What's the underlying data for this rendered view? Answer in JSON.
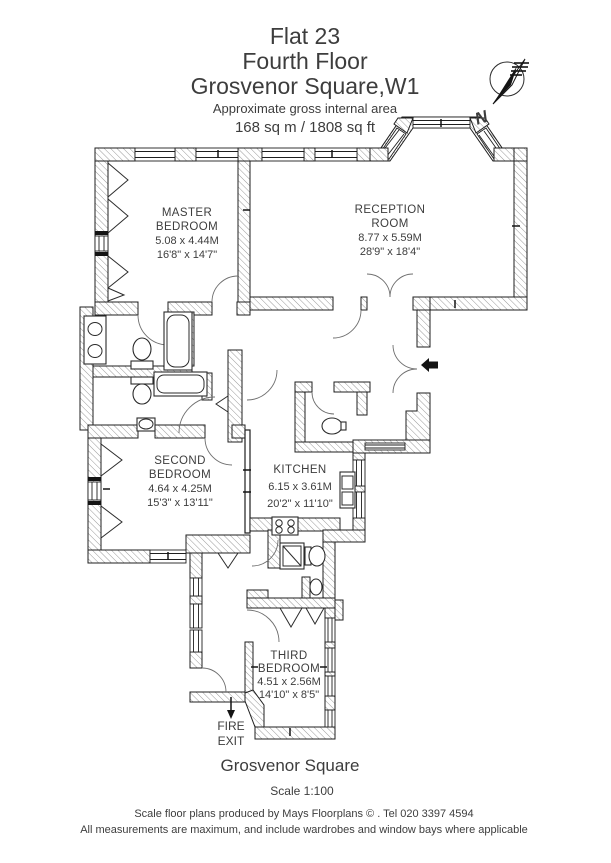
{
  "header": {
    "title1": "Flat 23",
    "title2": "Fourth Floor",
    "title3": "Grosvenor Square,W1",
    "subtitle": "Approximate gross internal area",
    "area": "168 sq m  /  1808 sq ft"
  },
  "compass": {
    "north": "N"
  },
  "rooms": {
    "master": {
      "lines": [
        "MASTER",
        "BEDROOM",
        "5.08 x 4.44M",
        "16'8\" x 14'7\""
      ]
    },
    "reception": {
      "lines": [
        "RECEPTION",
        "ROOM",
        "8.77 x 5.59M",
        "28'9\" x 18'4\""
      ]
    },
    "second": {
      "lines": [
        "SECOND",
        "BEDROOM",
        "4.64 x 4.25M",
        "15'3\" x 13'11\""
      ]
    },
    "kitchen": {
      "lines": [
        "KITCHEN",
        "6.15 x 3.61M",
        "20'2\" x 11'10\""
      ]
    },
    "third": {
      "lines": [
        "THIRD",
        "BEDROOM",
        "4.51 x 2.56M",
        "14'10\" x 8'5\""
      ]
    }
  },
  "fire": {
    "lines": [
      "FIRE",
      "EXIT"
    ]
  },
  "footer": {
    "location": "Grosvenor Square",
    "scale": "Scale 1:100",
    "credit": "Scale floor plans produced by Mays Floorplans © . Tel 020 3397 4594",
    "disclaimer": "All measurements are maximum, and include wardrobes and window bays where applicable"
  },
  "colors": {
    "wall_hatch": "#9a9a9a",
    "line": "#1f1f1f",
    "text": "#3d3d3d"
  }
}
